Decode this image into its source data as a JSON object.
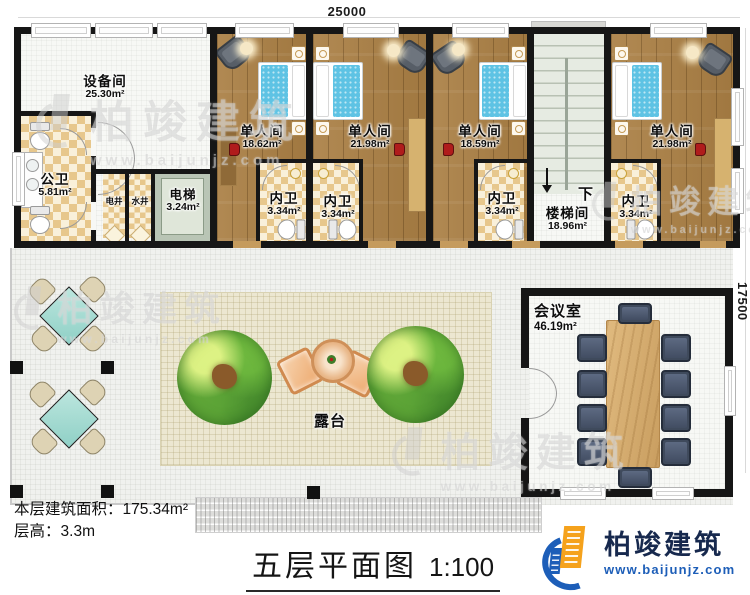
{
  "dimensions": {
    "top": "25000",
    "right": "17500"
  },
  "rooms": {
    "equipment": {
      "name": "设备间",
      "area": "25.30m²"
    },
    "public_wc": {
      "name": "公卫",
      "area": "5.81m²"
    },
    "electric_shaft": {
      "name": "电井"
    },
    "water_shaft": {
      "name": "水井"
    },
    "elevator": {
      "name": "电梯",
      "area": "3.24m²"
    },
    "bedroom1": {
      "name": "单人间",
      "area": "18.62m²"
    },
    "bedroom2": {
      "name": "单人间",
      "area": "21.98m²"
    },
    "bedroom3": {
      "name": "单人间",
      "area": "18.59m²"
    },
    "bedroom4": {
      "name": "单人间",
      "area": "21.98m²"
    },
    "bath1": {
      "name": "内卫",
      "area": "3.34m²"
    },
    "bath2": {
      "name": "内卫",
      "area": "3.34m²"
    },
    "bath3": {
      "name": "内卫",
      "area": "3.34m²"
    },
    "bath4": {
      "name": "内卫",
      "area": "3.34m²"
    },
    "stairwell": {
      "name": "楼梯间",
      "area": "18.96m²",
      "direction": "下"
    },
    "meeting": {
      "name": "会议室",
      "area": "46.19m²"
    },
    "terrace": {
      "name": "露台"
    }
  },
  "stats": {
    "area_label": "本层建筑面积：",
    "area_value": "175.34m²",
    "height_label": "层高：",
    "height_value": "3.3m"
  },
  "title": {
    "text": "五层平面图",
    "scale": "1:100"
  },
  "logo": {
    "name": "柏竣建筑",
    "url": "www.baijunjz.com"
  },
  "watermark": {
    "text": "柏竣建筑",
    "url": "www.baijunjz.com"
  },
  "colors": {
    "wall": "#161616",
    "wood_floor": "#aa7f44",
    "bed_blue": "#5ec3e4",
    "checker_tan": "#e7c78c",
    "stair_green": "#dfe5dc",
    "meeting_chair": "#3f4a5c",
    "terrace_mat": "#ece7d1",
    "logo_blue": "#1d5eb8",
    "logo_orange": "#f5a21c"
  }
}
